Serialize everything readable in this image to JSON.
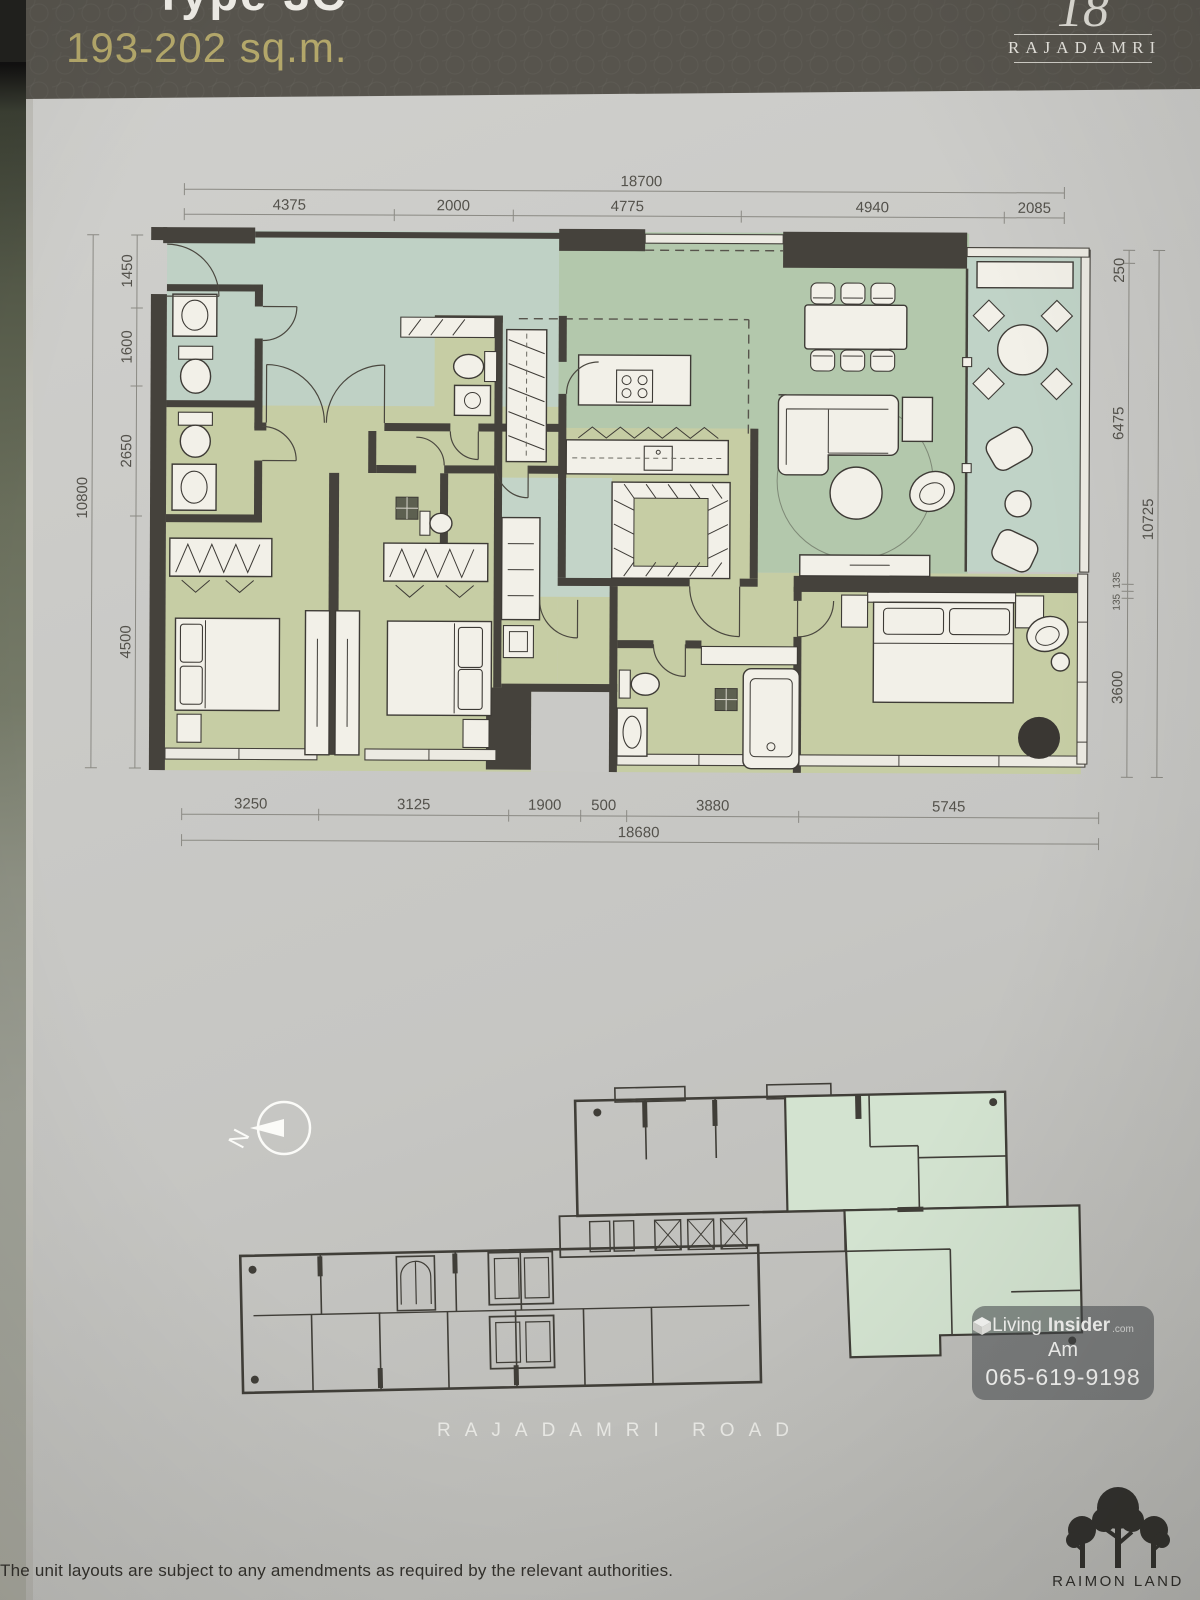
{
  "header": {
    "unit_type_partial": "Type 3C",
    "area": "193-202 sq.m.",
    "brand": "RAJADAMRI",
    "monogram": "18"
  },
  "floor_plan": {
    "dims_top": {
      "overall": "18700",
      "segments": [
        "4375",
        "2000",
        "4775",
        "4940",
        "2085"
      ]
    },
    "dims_left": {
      "overall": "10800",
      "segments": [
        "1450",
        "1600",
        "2650",
        "4500"
      ]
    },
    "dims_right": {
      "overall": "10725",
      "segments": [
        "250",
        "6475",
        "135",
        "135",
        "3600"
      ]
    },
    "dims_bottom": {
      "overall": "18680",
      "segments": [
        "3250",
        "3125",
        "1900",
        "500",
        "3880",
        "5745"
      ]
    }
  },
  "key_plan": {
    "north_label": "N",
    "road_label": "RAJADAMRI ROAD"
  },
  "watermark": {
    "brand_light": "Living",
    "brand_bold": "Insider",
    "brand_tld": ".com",
    "agent": "Am",
    "phone": "065-619-9198"
  },
  "footer": {
    "disclaimer": "The unit layouts are subject to any amendments as required by the relevant authorities.",
    "developer": "RAIMON LAND"
  },
  "colors": {
    "header_bg": "#57544d",
    "accent_gold": "#b3a76a",
    "wall": "#45423c",
    "room_green": "#b3c8ac",
    "room_blue": "#bfd1c5",
    "room_olive": "#c6cda4",
    "keyplan_highlight": "#d3e3d0",
    "paper": "#c9c9c6"
  }
}
